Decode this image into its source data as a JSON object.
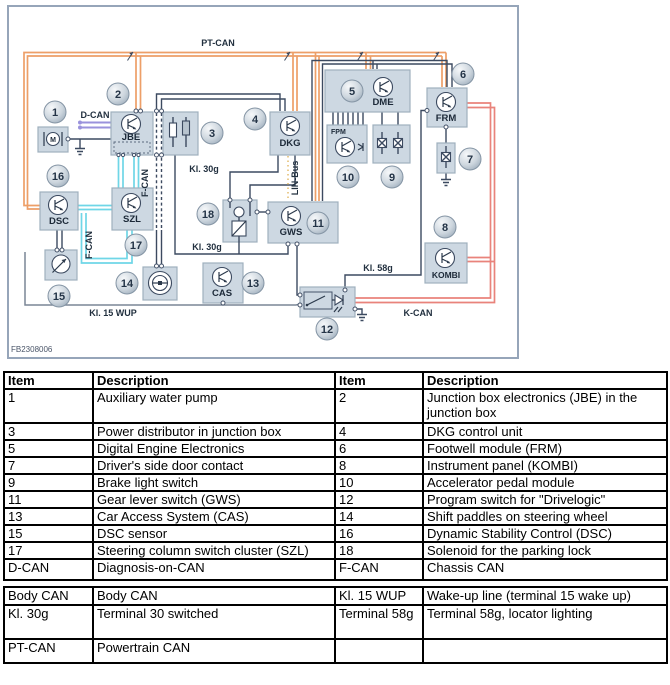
{
  "diagram": {
    "figure_id": "FB2308006",
    "item_numbers": [
      "1",
      "2",
      "3",
      "4",
      "5",
      "6",
      "7",
      "8",
      "9",
      "10",
      "11",
      "12",
      "13",
      "14",
      "15",
      "16",
      "17",
      "18"
    ],
    "modules": {
      "m_pump": "M",
      "jbe": "JBE",
      "dkg": "DKG",
      "dme": "DME",
      "fpm": "FPM",
      "frm": "FRM",
      "gws": "GWS",
      "kombi": "KOMBI",
      "cas": "CAS",
      "dsc": "DSC",
      "szl": "SZL"
    },
    "bus_labels": {
      "pt_can": "PT-CAN",
      "d_can": "D-CAN",
      "f_can": "F-CAN",
      "lin_bus": "LIN-Bus",
      "k_can": "K-CAN",
      "kl_30g": "Kl. 30g",
      "kl_58g": "Kl. 58g",
      "kl_15_wup": "Kl. 15 WUP"
    },
    "colors": {
      "pt_can": "#ED9F68",
      "k_can": "#E9837B",
      "f_can": "#6FD6E7",
      "d_can": "#9A92DC",
      "lin_bus": "#E7C47D",
      "wire": "#3C4A60",
      "wakeup": "#7A8696",
      "box_fill": "#CDD8E2",
      "box_stroke": "#9FB0BD",
      "frame": "#96A5B9"
    }
  },
  "legend_table": {
    "headers": [
      "Item",
      "Description",
      "Item",
      "Description"
    ],
    "rows": [
      [
        "1",
        "Auxiliary water pump",
        "2",
        "Junction box electronics (JBE) in the junction box"
      ],
      [
        "3",
        "Power distributor in junction box",
        "4",
        "DKG control unit"
      ],
      [
        "5",
        "Digital Engine Electronics",
        "6",
        "Footwell module (FRM)"
      ],
      [
        "7",
        "Driver's side door contact",
        "8",
        "Instrument panel (KOMBI)"
      ],
      [
        "9",
        "Brake light switch",
        "10",
        "Accelerator pedal module"
      ],
      [
        "11",
        "Gear lever switch (GWS)",
        "12",
        "Program switch for \"Drivelogic\""
      ],
      [
        "13",
        "Car Access System (CAS)",
        "14",
        "Shift paddles on steering wheel"
      ],
      [
        "15",
        "DSC sensor",
        "16",
        "Dynamic Stability Control (DSC)"
      ],
      [
        "17",
        "Steering column switch cluster (SZL)",
        "18",
        "Solenoid for the parking lock"
      ],
      [
        "D-CAN",
        "Diagnosis-on-CAN",
        "F-CAN",
        "Chassis CAN"
      ],
      [
        "Body CAN",
        "Body CAN",
        "Kl. 15 WUP",
        "Wake-up line (terminal 15 wake up)"
      ],
      [
        "Kl. 30g",
        "Terminal 30 switched",
        "Terminal 58g",
        "Terminal 58g, locator lighting"
      ],
      [
        "PT-CAN",
        "Powertrain CAN",
        "",
        ""
      ]
    ]
  }
}
